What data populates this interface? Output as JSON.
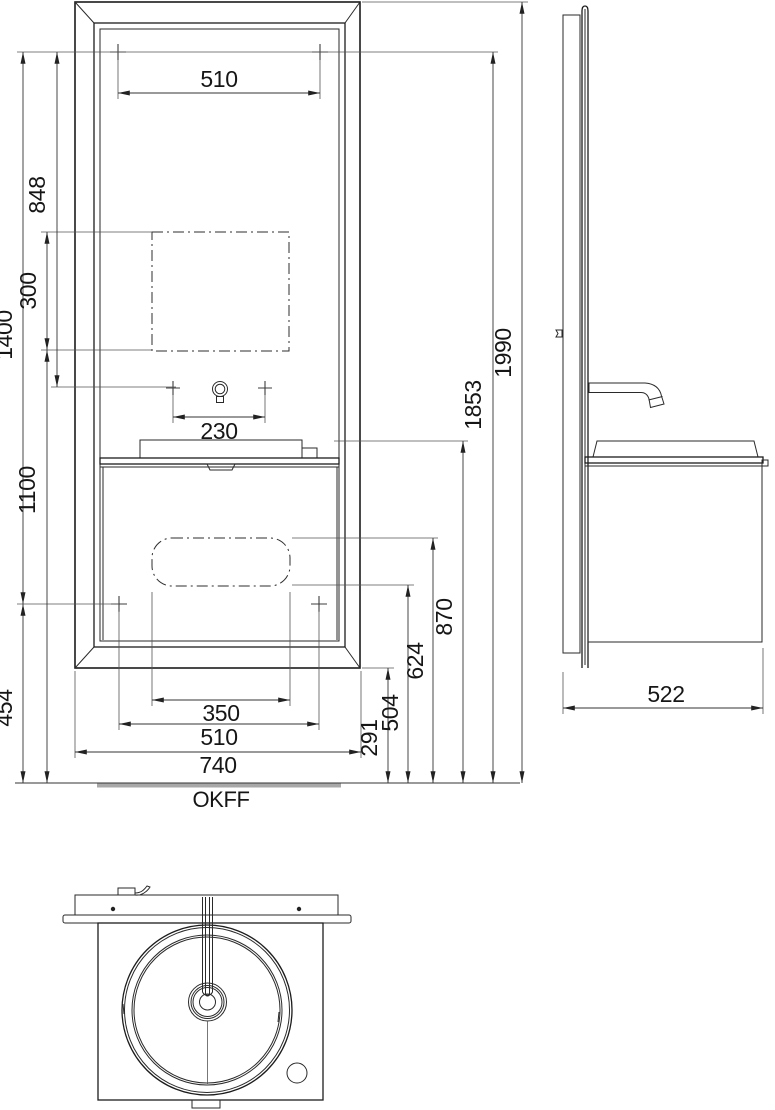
{
  "dimensions": {
    "mirror_hanger_width": "510",
    "hanger_to_faucet": "848",
    "mirror_cutout_height": "300",
    "fixing_chain_height": "1400",
    "faucet_hole_spacing": "230",
    "cutout_bottom_height": "1100",
    "lower_fixing_height": "454",
    "service_cutout_width": "350",
    "lower_fixing_width": "510",
    "frame_width": "740",
    "frame_bottom_clearance": "291",
    "service_cutout_bottom": "504",
    "service_cutout_top": "624",
    "worktop_height": "870",
    "upper_fixing_height": "1853",
    "frame_top_height": "1990",
    "unit_depth": "522"
  },
  "labels": {
    "floor_reference": "OKFF"
  }
}
